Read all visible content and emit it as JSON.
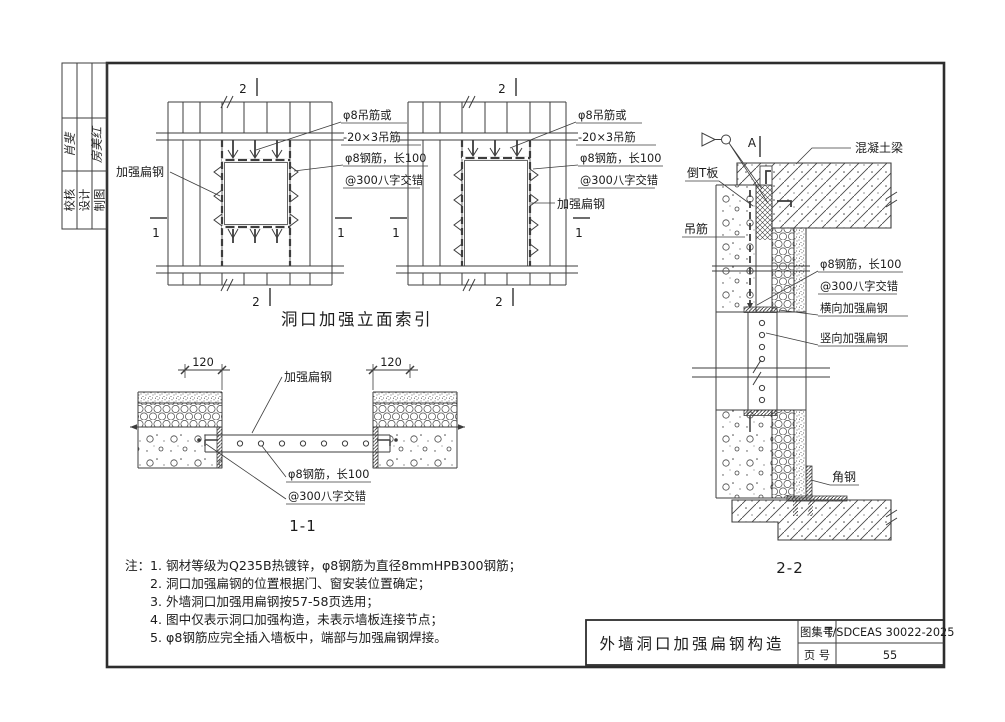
{
  "page": {
    "approval_table": {
      "rows": [
        {
          "label": "校核",
          "signature": "肖斐"
        },
        {
          "label": "设计",
          "signature": "房美红"
        },
        {
          "label": "制图",
          "signature": ""
        }
      ]
    },
    "elevations": {
      "caption": "洞口加强立面索引",
      "marker_vertical": "2",
      "marker_horizontal": "1",
      "labels": {
        "flat_steel": "加强扁钢",
        "hanger_line1": "φ8吊筋或",
        "hanger_line2": "-20×3吊筋",
        "rebar_line1": "φ8钢筋，长100",
        "rebar_line2": "@300八字交错"
      }
    },
    "section_1_1": {
      "caption": "1-1",
      "dim_left": "120",
      "dim_right": "120",
      "labels": {
        "flat_steel": "加强扁钢",
        "rebar_line1": "φ8钢筋，长100",
        "rebar_line2": "@300八字交错"
      }
    },
    "section_2_2": {
      "caption": "2-2",
      "detail_marker": "A",
      "labels": {
        "concrete_beam": "混凝土梁",
        "inverted_t_panel": "倒T板",
        "hanger_bar": "吊筋",
        "rebar_line1": "φ8钢筋，长100",
        "rebar_line2": "@300八字交错",
        "horizontal_flat_steel": "横向加强扁钢",
        "vertical_flat_steel": "竖向加强扁钢",
        "angle_steel": "角钢"
      }
    },
    "notes": {
      "prefix": "注：",
      "items": [
        "1. 钢材等级为Q235B热镀锌，φ8钢筋为直径8mmHPB300钢筋；",
        "2. 洞口加强扁钢的位置根据门、窗安装位置确定；",
        "3. 外墙洞口加强用扁钢按57-58页选用；",
        "4. 图中仅表示洞口加强构造，未表示墙板连接节点；",
        "5. φ8钢筋应完全插入墙板中，端部与加强扁钢焊接。"
      ]
    },
    "title_block": {
      "drawing_title": "外墙洞口加强扁钢构造",
      "atlas_no_label": "图集号",
      "atlas_no_value": "T/SDCEAS 30022-2025",
      "page_no_label": "页 号",
      "page_no_value": "55"
    },
    "colors": {
      "line": "#3d3d3d",
      "text": "#1c1c1c",
      "background": "#ffffff"
    }
  }
}
